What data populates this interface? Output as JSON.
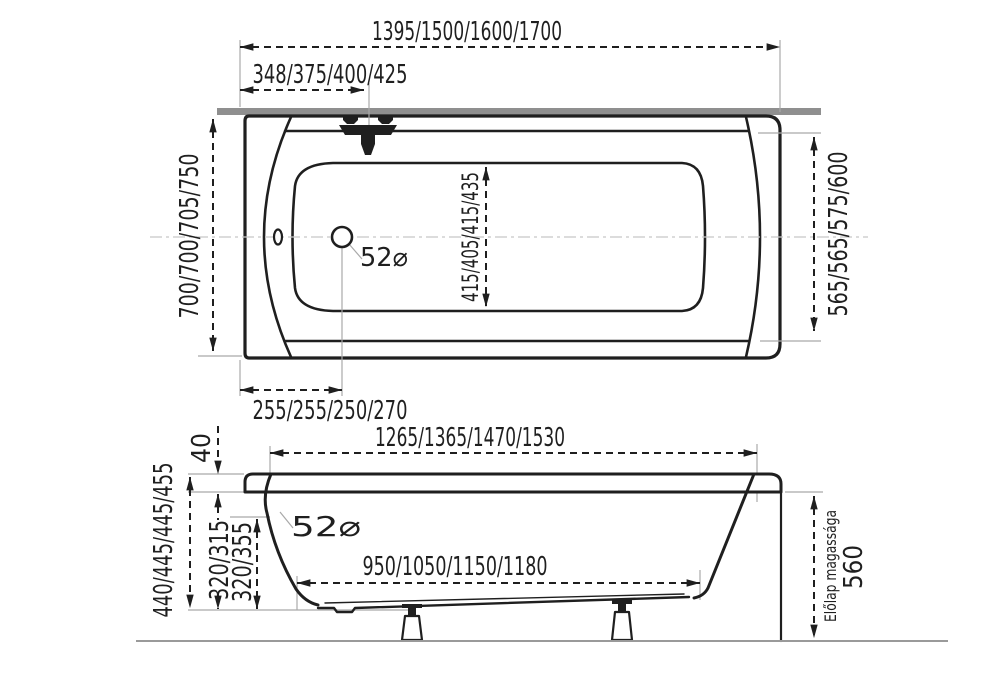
{
  "top_view": {
    "overall_length": "1395/1500/1600/1700",
    "overflow_offset": "348/375/400/425",
    "overall_width": "700/700/705/750",
    "inner_width": "565/565/575/600",
    "basin_width": "415/405/415/435",
    "drain_offset": "255/255/250/270",
    "drain_diameter": "52⌀"
  },
  "side_view": {
    "rim_inner_length": "1265/1365/1470/1530",
    "bottom_length": "950/1050/1150/1180",
    "rim_height": "40",
    "overall_height": "440/445/445/455",
    "depth_a": "320/315",
    "depth_b": "320/355",
    "overflow_diameter": "52⌀",
    "front_panel_label": "Előlap magassága",
    "front_panel_height": "560"
  },
  "colors": {
    "line": "#1f1f1f",
    "wall": "#8f8f8f",
    "ext": "#a9a9a9",
    "center": "#c8c8c8",
    "floor": "#9a9a9a"
  }
}
